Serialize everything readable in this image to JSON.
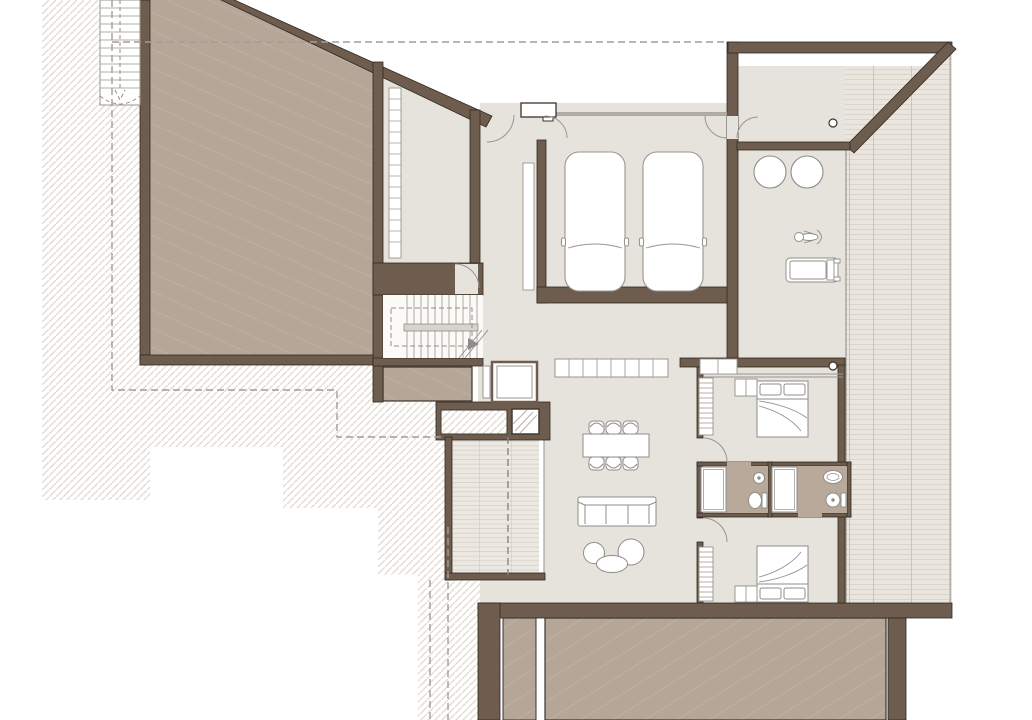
{
  "drawing": {
    "kind": "architectural-floor-plan",
    "view": "top-down plan with cut walls, terrain hatch, roof/terrace fills",
    "text_labels": []
  },
  "palette": {
    "wall_brown": "#6e5d4e",
    "wall_outline": "#2f2820",
    "roof_fill_taupe": "#b5a698",
    "roof_hatch_line": "#c8bcae",
    "interior_floor": "#e6e2dc",
    "bath_floor": "#b8a99b",
    "deck_base": "#eae5df",
    "deck_plank_line": "#d6cec4",
    "deck_joint_line": "#c6bdb2",
    "ground_hatch": "#e3dcd3",
    "furniture_stroke": "#8f8d89",
    "dashed_line": "#a49d94",
    "background": "#ffffff"
  },
  "inventory": {
    "garage_cars": 2,
    "bedrooms": 2,
    "double_beds": 2,
    "bathrooms": 2,
    "showers": 2,
    "toilets": 2,
    "sinks": 2,
    "dining_chairs": 6,
    "dining_tables": 1,
    "sofas": 1,
    "lounge_circles_gym": 2,
    "gym_machines": 2,
    "stair_runs_interior": 2,
    "exterior_stairs": 1,
    "elevator": 1,
    "columns": 2,
    "wardrobes": 3,
    "kitchen_counter_cells": 8
  }
}
